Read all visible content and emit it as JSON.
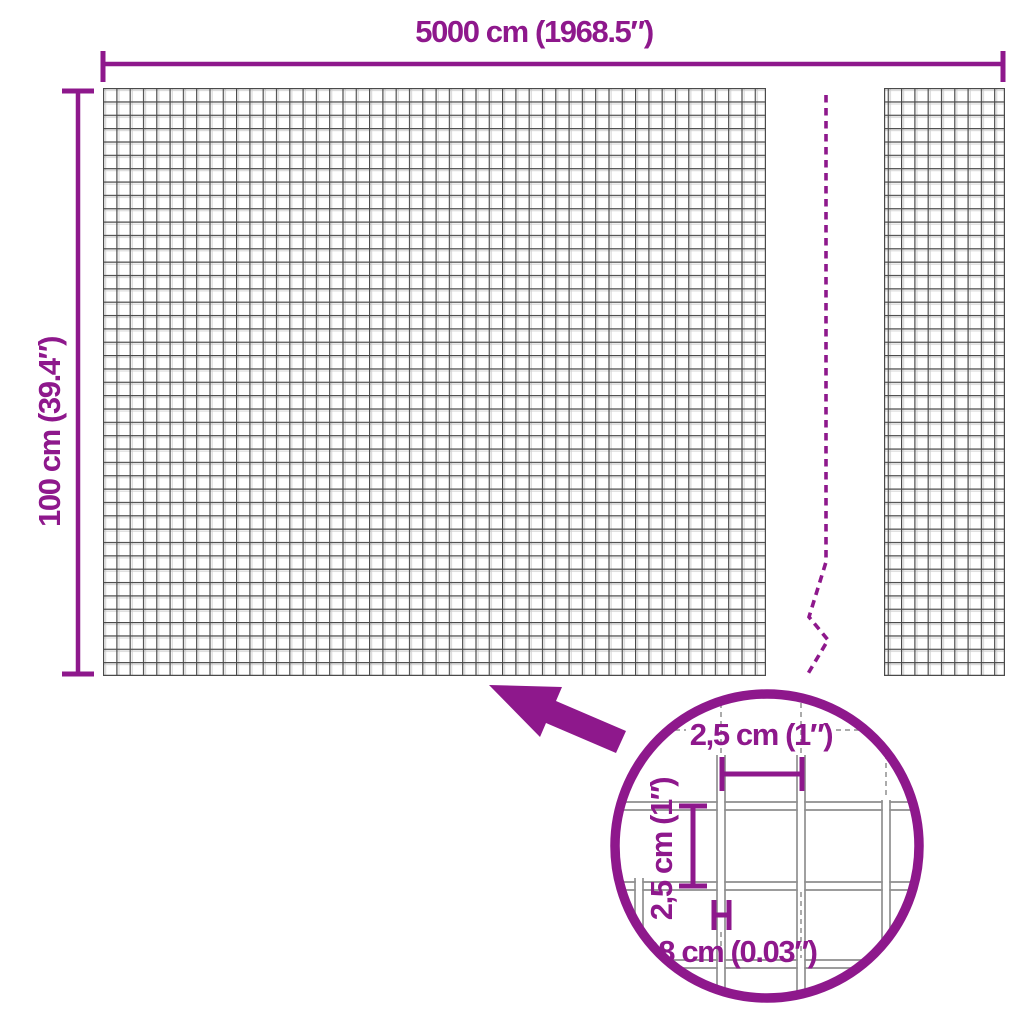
{
  "colors": {
    "accent": "#8E188C",
    "mesh_dark": "#4a4a4a",
    "mesh_light": "#cfcfcf",
    "wire_gray": "#8f8f8f",
    "background": "#ffffff"
  },
  "overall_dimensions": {
    "width_label": "5000 cm (1968.5″)",
    "height_label": "100 cm (39.4″)"
  },
  "detail_view": {
    "horizontal_spacing_label": "2,5 cm (1″)",
    "vertical_spacing_label": "2,5 cm (1″)",
    "wire_thickness_label": "0,08 cm (0.03″)"
  },
  "icons": {
    "zoom_arrow": "zoom-arrow-icon",
    "magnifier_circle": "magnifier-circle",
    "break_line": "mesh-break-line"
  }
}
